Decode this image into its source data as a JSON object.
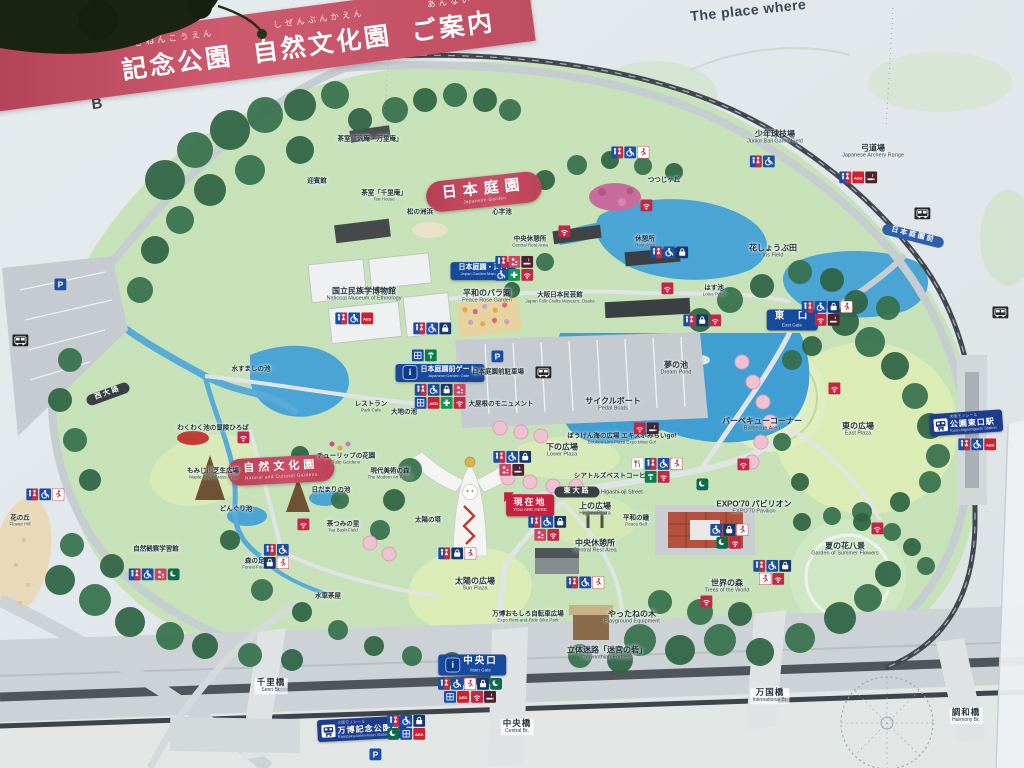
{
  "banner": {
    "furigana1": "きねんこうえん",
    "part1": "記念公園",
    "furigana2": "しぜんぶんかえん",
    "part2": "自然文化園",
    "furigana3": "あんない",
    "part3": "ご案内"
  },
  "top_right_text": "The place where",
  "colors": {
    "banner_pink": "#c9566a",
    "badge_red": "#c5204e",
    "gate_blue": "#17499c",
    "station_blue": "#1c3c8e",
    "water_blue": "#4aa4d4",
    "park_green": "#c7e2b9",
    "lawn_green": "#dcecb6",
    "road_gray": "#c6cdd0",
    "monorail_dark": "#40474e"
  },
  "map": {
    "grid_letters": [
      {
        "t": "B",
        "x": 97,
        "y": 104
      },
      {
        "t": "C",
        "x": 236,
        "y": 69
      },
      {
        "t": "D",
        "x": 396,
        "y": 31
      }
    ],
    "labels": [
      {
        "n": "japanese-garden-badge",
        "k": "park-red",
        "t": "日本庭園",
        "e": "Japanese Garden",
        "x": 484,
        "y": 192,
        "r": -6
      },
      {
        "n": "nature-culture-garden-badge",
        "k": "park-red sm",
        "t": "自然文化園",
        "e": "Natural and Cultural Gardens",
        "x": 281,
        "y": 470,
        "r": -3
      },
      {
        "n": "you-are-here-badge",
        "k": "here",
        "t": "現在地",
        "e": "YOU ARE HERE",
        "x": 530,
        "y": 505
      },
      {
        "n": "east-gate-label",
        "k": "gate",
        "t": "東　口",
        "e": "East Gate",
        "x": 792,
        "y": 320
      },
      {
        "n": "main-gate-label",
        "k": "gate gate-i",
        "t": "中央口",
        "e": "Main Gate",
        "x": 472,
        "y": 665
      },
      {
        "n": "japan-garden-main-gate-label",
        "k": "gate xs",
        "t": "日本庭園・正門",
        "e": "Japan Garden Main Gate",
        "x": 483,
        "y": 271
      },
      {
        "n": "japanese-garden-gate-label",
        "k": "gate gate-i xs",
        "t": "日本庭園前ゲート",
        "e": "Japanese Garden Gate",
        "x": 440,
        "y": 373
      },
      {
        "n": "koen-higashiguchi-station-label",
        "k": "station",
        "p": "大阪モノレール",
        "t": "公園東口駅",
        "e": "Koen-higashiguchi Station",
        "x": 966,
        "y": 423,
        "r": -4
      },
      {
        "n": "bampaku-kinen-koen-station-label",
        "k": "station",
        "p": "大阪モノレール",
        "t": "万博記念公園駅",
        "e": "Bampaku-kinen-koen Station",
        "x": 362,
        "y": 729,
        "r": -3
      },
      {
        "n": "nihon-teien-mae-busstop-label",
        "k": "street blue",
        "t": "日本庭園前",
        "x": 913,
        "y": 236,
        "r": 14
      },
      {
        "n": "higashi-oji-street-label",
        "k": "street",
        "t": "東大路",
        "e": "Higashi-oji Street",
        "x": 577,
        "y": 492
      },
      {
        "n": "nishi-oji-street-label",
        "k": "street",
        "t": "西大路",
        "x": 108,
        "y": 394,
        "r": -20
      },
      {
        "n": "shinji-pond-label",
        "k": "tiny",
        "t": "心字池",
        "x": 502,
        "y": 212
      },
      {
        "n": "jg-central-rest-label",
        "k": "tiny",
        "t": "中央休憩所",
        "e": "Central Rest Area",
        "x": 530,
        "y": 242
      },
      {
        "n": "rest-area-label",
        "k": "tiny",
        "t": "休憩所",
        "e": "Rest Area",
        "x": 645,
        "y": 242
      },
      {
        "n": "tsutsuji-hill-label",
        "k": "tiny",
        "t": "つつじヶ丘",
        "x": 664,
        "y": 180
      },
      {
        "n": "lotus-pond-label",
        "k": "tiny",
        "t": "はす池",
        "e": "Lotus Pond",
        "x": 714,
        "y": 291
      },
      {
        "n": "iris-field-label",
        "k": "place",
        "t": "花しょうぶ田",
        "e": "Iris Field",
        "x": 773,
        "y": 251
      },
      {
        "n": "junior-ball-field-label",
        "k": "place",
        "t": "少年球技場",
        "e": "Junior Ball Game Field",
        "x": 775,
        "y": 137
      },
      {
        "n": "archery-range-label",
        "k": "place",
        "t": "弓道場",
        "e": "Japanese Archery Range",
        "x": 873,
        "y": 151
      },
      {
        "n": "peace-rose-garden-label",
        "k": "place",
        "t": "平和のバラ園",
        "e": "Peace Rose Garden",
        "x": 487,
        "y": 296
      },
      {
        "n": "folk-crafts-museum-label",
        "k": "tiny",
        "t": "大阪日本民芸館",
        "e": "Japan Folk Crafts Museum, Osaka",
        "x": 560,
        "y": 298
      },
      {
        "n": "ethnology-museum-label",
        "k": "place",
        "t": "国立民族学博物館",
        "e": "National Museum of Ethnology",
        "x": 364,
        "y": 294
      },
      {
        "n": "geihinkan-label",
        "k": "tiny",
        "t": "迎賓館",
        "x": 317,
        "y": 181
      },
      {
        "n": "tearoom-hanan-banrian-label",
        "k": "tiny",
        "t": "茶室「汎庵・万里庵」",
        "x": 370,
        "y": 139
      },
      {
        "n": "tearoom-senrian-label",
        "k": "tiny",
        "t": "茶室「千里庵」",
        "e": "Tea House",
        "x": 384,
        "y": 196
      },
      {
        "n": "pine-beach-label",
        "k": "tiny",
        "t": "松の洲浜",
        "x": 420,
        "y": 212
      },
      {
        "n": "roof-monument-label",
        "k": "tiny",
        "t": "大屋根のモニュメント",
        "x": 501,
        "y": 404
      },
      {
        "n": "jg-parking-label",
        "k": "tiny",
        "t": "日本庭園前駐車場",
        "x": 498,
        "y": 372
      },
      {
        "n": "park-cafe-label",
        "k": "tiny",
        "t": "レストラン",
        "e": "Park Cafe",
        "x": 371,
        "y": 407
      },
      {
        "n": "dream-pond-label",
        "k": "place",
        "t": "夢の池",
        "e": "Dream Pond",
        "x": 676,
        "y": 368
      },
      {
        "n": "pedal-boats-label",
        "k": "place",
        "t": "サイクルボート",
        "e": "Pedal Boats",
        "x": 613,
        "y": 404
      },
      {
        "n": "barbecue-area-label",
        "k": "place",
        "t": "バーベキューコーナー",
        "e": "Barbecue Area",
        "x": 762,
        "y": 424
      },
      {
        "n": "east-plaza-label",
        "k": "place",
        "t": "東の広場",
        "e": "East Plaza",
        "x": 858,
        "y": 429
      },
      {
        "n": "lower-plaza-label",
        "k": "place",
        "t": "下の広場",
        "e": "Lower Plaza",
        "x": 562,
        "y": 450
      },
      {
        "n": "bouken-umi-plaza-label",
        "k": "tiny",
        "t": "ぼうけん海の広場 エキスポみらいgo!",
        "e": "Bouken-Umi Plaza Expo Mirai Go!",
        "x": 622,
        "y": 439
      },
      {
        "n": "seattles-best-coffee-label",
        "k": "tiny",
        "t": "シアトルズベストコーヒー",
        "x": 613,
        "y": 476
      },
      {
        "n": "higher-plaza-label",
        "k": "place",
        "t": "上の広場",
        "e": "Higher Plaza",
        "x": 595,
        "y": 509
      },
      {
        "n": "peace-bell-label",
        "k": "tiny",
        "t": "平和の鐘",
        "e": "Peace Bell",
        "x": 636,
        "y": 521
      },
      {
        "n": "central-rest-area-label",
        "k": "place",
        "t": "中央休憩所",
        "e": "Central Rest Area",
        "x": 595,
        "y": 546
      },
      {
        "n": "tower-of-the-sun-label",
        "k": "tiny",
        "t": "太陽の塔",
        "x": 428,
        "y": 520
      },
      {
        "n": "sun-plaza-label",
        "k": "place",
        "t": "太陽の広場",
        "e": "Sun Plaza",
        "x": 475,
        "y": 584
      },
      {
        "n": "bike-park-label",
        "k": "tiny",
        "t": "万博おもしろ自転車広場",
        "e": "Expo Rent-and-Ride Bike Park",
        "x": 528,
        "y": 617
      },
      {
        "n": "yattane-tree-label",
        "k": "place",
        "t": "やったねの木",
        "e": "Playground Equipment",
        "x": 632,
        "y": 617
      },
      {
        "n": "labyrinth-label",
        "k": "place",
        "t": "立体迷路「迷宮の砦」",
        "e": "Labyrinthian Fortress",
        "x": 607,
        "y": 653
      },
      {
        "n": "trees-of-world-label",
        "k": "place",
        "t": "世界の森",
        "e": "Trees of the World",
        "x": 727,
        "y": 586
      },
      {
        "n": "expo70-pavilion-label",
        "k": "place",
        "t": "EXPO'70 パビリオン",
        "e": "EXPO'70 Pavilion",
        "x": 754,
        "y": 507
      },
      {
        "n": "summer-flowers-label",
        "k": "place",
        "t": "夏の花八景",
        "e": "Garden of Summer Flowers",
        "x": 845,
        "y": 549
      },
      {
        "n": "tulip-gardens-label",
        "k": "tiny",
        "t": "チューリップの花園",
        "e": "Tulip Gardens",
        "x": 346,
        "y": 459
      },
      {
        "n": "modern-art-forest-label",
        "k": "tiny",
        "t": "現代美術の森",
        "e": "The Modern Art Forest",
        "x": 390,
        "y": 474
      },
      {
        "n": "sunny-pond-label",
        "k": "tiny",
        "t": "日だまりの池",
        "x": 331,
        "y": 490
      },
      {
        "n": "maple-river-grass-label",
        "k": "tiny",
        "t": "もみじ川芝生広場",
        "e": "Maple River Grass Area",
        "x": 213,
        "y": 474
      },
      {
        "n": "acorn-pond-label",
        "k": "tiny",
        "t": "どんぐり池",
        "x": 236,
        "y": 509
      },
      {
        "n": "tea-bush-field-label",
        "k": "tiny",
        "t": "茶つみの里",
        "e": "Tea Bush Field",
        "x": 343,
        "y": 527
      },
      {
        "n": "forest-footbath-label",
        "k": "tiny",
        "t": "森の足湯",
        "e": "Forest Footbath",
        "x": 258,
        "y": 564
      },
      {
        "n": "flower-hill-label",
        "k": "tiny",
        "t": "花の丘",
        "e": "Flower Hill",
        "x": 20,
        "y": 521
      },
      {
        "n": "nature-observation-label",
        "k": "tiny",
        "t": "自然観察学習館",
        "x": 156,
        "y": 549
      },
      {
        "n": "wakuwaku-playground-label",
        "k": "tiny",
        "t": "わくわく池の冒険ひろば",
        "x": 213,
        "y": 428
      },
      {
        "n": "mizusumashi-pond-label",
        "k": "tiny",
        "t": "水すましの池",
        "x": 251,
        "y": 369
      },
      {
        "n": "daichi-pond-label",
        "k": "tiny",
        "t": "大地の池",
        "x": 404,
        "y": 412
      },
      {
        "n": "waterwheel-teahouse-label",
        "k": "tiny",
        "t": "水車茶屋",
        "x": 328,
        "y": 596
      },
      {
        "n": "senri-bridge-label",
        "k": "bridge",
        "t": "千里橋",
        "e": "Senri Br.",
        "x": 271,
        "y": 686
      },
      {
        "n": "central-bridge-label",
        "k": "bridge",
        "t": "中央橋",
        "e": "Central Br.",
        "x": 517,
        "y": 727
      },
      {
        "n": "international-bridge-label",
        "k": "bridge",
        "t": "万国橋",
        "e": "International Br.",
        "x": 770,
        "y": 696
      },
      {
        "n": "harmony-bridge-label",
        "k": "bridge",
        "t": "調和橋",
        "e": "Harmony Br.",
        "x": 966,
        "y": 716
      }
    ],
    "icon_clusters": [
      {
        "x": 762,
        "y": 161,
        "rows": [
          [
            "wc",
            "hc"
          ]
        ]
      },
      {
        "x": 858,
        "y": 177,
        "rows": [
          [
            "wc",
            "aed",
            "smoke"
          ]
        ]
      },
      {
        "x": 630,
        "y": 152,
        "rows": [
          [
            "wc",
            "hc",
            "run"
          ]
        ]
      },
      {
        "x": 669,
        "y": 252,
        "rows": [
          [
            "wc",
            "hc",
            "bag"
          ]
        ]
      },
      {
        "x": 514,
        "y": 268,
        "rows": [
          [
            "wc",
            "nurse",
            "smoke"
          ],
          [
            "hc",
            "cross",
            "wifi"
          ]
        ]
      },
      {
        "x": 827,
        "y": 313,
        "rows": [
          [
            "wc",
            "hc",
            "bag",
            "run"
          ],
          [
            "wifi",
            "smoke"
          ]
        ]
      },
      {
        "x": 354,
        "y": 318,
        "rows": [
          [
            "wc",
            "hc",
            "aed"
          ]
        ]
      },
      {
        "x": 432,
        "y": 328,
        "rows": [
          [
            "wc",
            "hc",
            "bag"
          ]
        ]
      },
      {
        "x": 702,
        "y": 320,
        "rows": [
          [
            "wc",
            "bag",
            "wifi"
          ]
        ]
      },
      {
        "x": 424,
        "y": 355,
        "rows": [
          [
            "locker",
            "phone"
          ]
        ]
      },
      {
        "x": 440,
        "y": 396,
        "rows": [
          [
            "wc",
            "hc",
            "bag",
            "nurse"
          ],
          [
            "locker",
            "aed",
            "cross",
            "wifi"
          ]
        ]
      },
      {
        "x": 657,
        "y": 470,
        "rows": [
          [
            "food",
            "wc",
            "hc",
            "run"
          ],
          [
            "phone",
            "wifi"
          ]
        ]
      },
      {
        "x": 512,
        "y": 463,
        "rows": [
          [
            "wc",
            "hc",
            "bag"
          ],
          [
            "nurse",
            "smoke"
          ]
        ]
      },
      {
        "x": 547,
        "y": 528,
        "rows": [
          [
            "wc",
            "hc",
            "bag"
          ],
          [
            "nurse",
            "wifi"
          ]
        ]
      },
      {
        "x": 729,
        "y": 536,
        "rows": [
          [
            "hc",
            "bag",
            "run"
          ],
          [
            "moon",
            "wifi"
          ]
        ]
      },
      {
        "x": 772,
        "y": 572,
        "rows": [
          [
            "wc",
            "hc",
            "bag"
          ],
          [
            "run",
            "wifi"
          ]
        ]
      },
      {
        "x": 585,
        "y": 582,
        "rows": [
          [
            "wc",
            "hc",
            "run"
          ]
        ]
      },
      {
        "x": 457,
        "y": 553,
        "rows": [
          [
            "wc",
            "bag",
            "run"
          ]
        ]
      },
      {
        "x": 470,
        "y": 690,
        "rows": [
          [
            "wc",
            "hc",
            "run",
            "bag",
            "moon"
          ],
          [
            "locker",
            "aed",
            "wifi",
            "smoke"
          ]
        ]
      },
      {
        "x": 406,
        "y": 727,
        "rows": [
          [
            "wc",
            "hc",
            "bag"
          ],
          [
            "moon",
            "locker",
            "aed"
          ]
        ]
      },
      {
        "x": 977,
        "y": 444,
        "rows": [
          [
            "wc",
            "hc",
            "aed"
          ]
        ]
      },
      {
        "x": 45,
        "y": 494,
        "rows": [
          [
            "wc",
            "hc",
            "run"
          ]
        ]
      },
      {
        "x": 276,
        "y": 556,
        "rows": [
          [
            "wc",
            "hc"
          ],
          [
            "bag",
            "run"
          ]
        ]
      },
      {
        "x": 154,
        "y": 574,
        "rows": [
          [
            "wc",
            "hc",
            "nurse",
            "moon"
          ]
        ]
      },
      {
        "x": 646,
        "y": 428,
        "rows": [
          [
            "wifi",
            "smoke"
          ]
        ]
      }
    ],
    "single_icons": [
      {
        "t": "wifi",
        "x": 646,
        "y": 205
      },
      {
        "t": "wifi",
        "x": 667,
        "y": 288
      },
      {
        "t": "wifi",
        "x": 564,
        "y": 231
      },
      {
        "t": "wifi",
        "x": 834,
        "y": 388
      },
      {
        "t": "wifi",
        "x": 877,
        "y": 528
      },
      {
        "t": "wifi",
        "x": 743,
        "y": 464
      },
      {
        "t": "wifi",
        "x": 706,
        "y": 601
      },
      {
        "t": "wifi",
        "x": 303,
        "y": 524
      },
      {
        "t": "wifi",
        "x": 243,
        "y": 437
      },
      {
        "t": "bus",
        "x": 922,
        "y": 213
      },
      {
        "t": "bus",
        "x": 1000,
        "y": 312
      },
      {
        "t": "bus",
        "x": 543,
        "y": 372
      },
      {
        "t": "bus",
        "x": 20,
        "y": 340
      },
      {
        "t": "p",
        "x": 60,
        "y": 284
      },
      {
        "t": "p",
        "x": 497,
        "y": 356
      },
      {
        "t": "p",
        "x": 375,
        "y": 754
      },
      {
        "t": "moon",
        "x": 702,
        "y": 484
      }
    ]
  }
}
